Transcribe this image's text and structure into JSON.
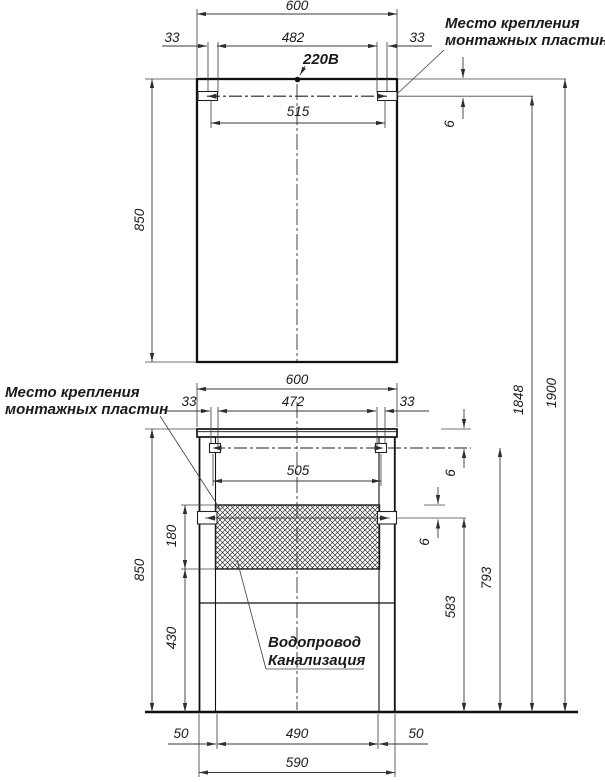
{
  "labels": {
    "mount_plates_top": {
      "line1": "Место крепления",
      "line2": "монтажных пластин"
    },
    "mount_plates_left": {
      "line1": "Место крепления",
      "line2": "монтажных пластин"
    },
    "power": "220В",
    "plumbing": {
      "line1": "Водопровод",
      "line2": "Канализация"
    }
  },
  "dims": {
    "mirror_width": "600",
    "mirror_offset_left": "33",
    "mirror_plate_span": "482",
    "mirror_offset_right": "33",
    "mirror_mount_width": "515",
    "mirror_height": "850",
    "mirror_gap": "6",
    "cabinet_width": "600",
    "cabinet_offset_left": "33",
    "cabinet_plate_span": "472",
    "cabinet_offset_right": "33",
    "cabinet_mount_width": "505",
    "cabinet_height": "850",
    "cabinet_gap": "6",
    "basin_gap": "6",
    "service_zone_height": "180",
    "zone_to_floor": "430",
    "basin_mount_height": "583",
    "cabinet_mount_height": "793",
    "mirror_mount_height": "1848",
    "overall_height": "1900",
    "plinth_offset_left": "50",
    "leg_span": "490",
    "plinth_offset_right": "50",
    "body_width": "590"
  }
}
